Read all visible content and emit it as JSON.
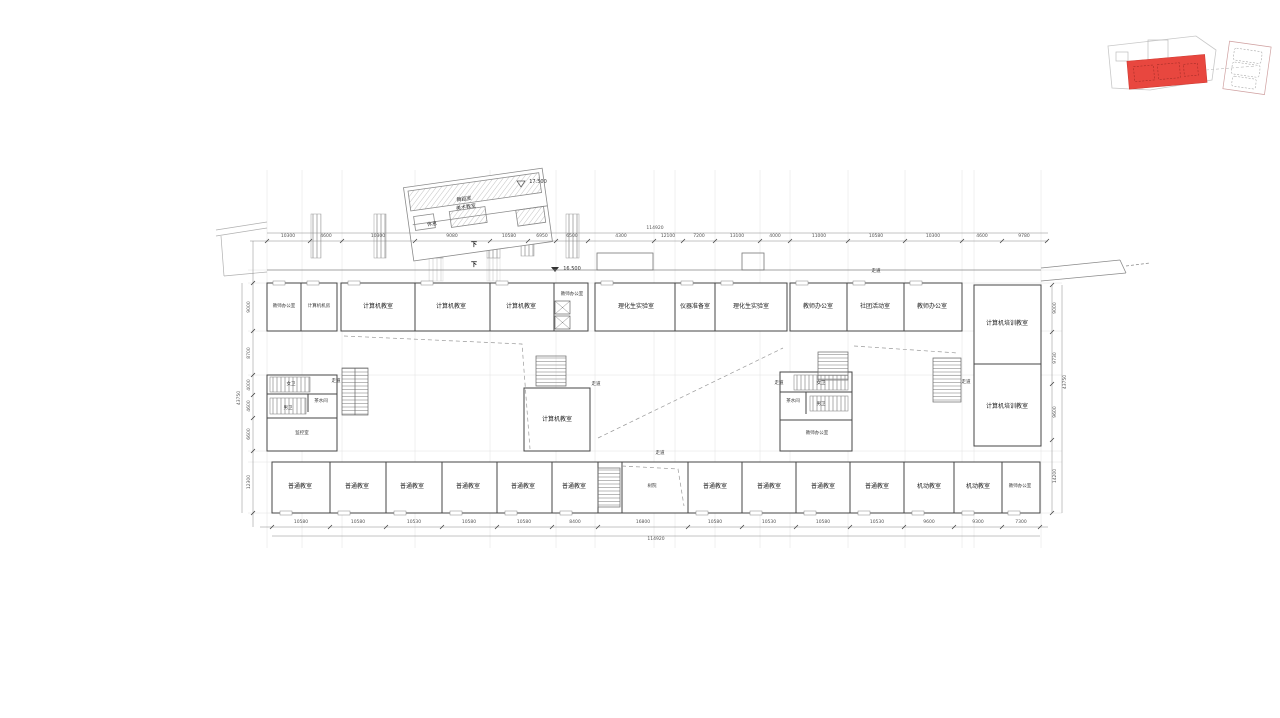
{
  "drawing": {
    "key_plan": {
      "highlight_color": "#e8473f"
    },
    "levels": {
      "annex": "17.500",
      "main": "16.500"
    },
    "labels": {
      "corridor": "走道",
      "down": "下",
      "annex_room1": "舞蹈室",
      "annex_room2": "美术教室",
      "annex_rest": "休息"
    },
    "rooms": {
      "top": [
        "教师办公室",
        "计算机机房",
        "计算机教室",
        "计算机教室",
        "计算机教室",
        "教师办公室",
        "理化生实验室",
        "仪器准备室",
        "理化生实验室",
        "教师办公室",
        "社团活动室",
        "教师办公室"
      ],
      "right_wing": [
        "计算机培训教室",
        "计算机培训教室"
      ],
      "core_left": {
        "women": "女卫",
        "men": "男卫",
        "tea": "茶水间",
        "monitor": "监控室"
      },
      "core_mid": {
        "women": "女卫",
        "men": "男卫",
        "tea": "茶水间",
        "office": "教师办公室"
      },
      "center_room": "计算机教室",
      "tree_court": "树院",
      "bottom": [
        "普通教室",
        "普通教室",
        "普通教室",
        "普通教室",
        "普通教室",
        "普通教室",
        "普通教室",
        "普通教室",
        "普通教室",
        "普通教室",
        "机动教室",
        "机动教室",
        "教师办公室"
      ]
    },
    "dims": {
      "top": [
        "10300",
        "4600",
        "10300",
        "9080",
        "10580",
        "6950",
        "6500",
        "4300",
        "12100",
        "7200",
        "13100",
        "4000",
        "11000",
        "10580",
        "10300",
        "4600",
        "9780"
      ],
      "top_total": "114920",
      "bottom": [
        "10580",
        "10580",
        "10530",
        "10580",
        "10580",
        "8400",
        "16800",
        "10580",
        "10530",
        "10580",
        "10530",
        "9600",
        "9300",
        "7300"
      ],
      "bottom_total": "114920",
      "left": [
        "9000",
        "8700",
        "4000",
        "4600",
        "6600",
        "12300"
      ],
      "left_total": "43750",
      "right": [
        "9000",
        "9730",
        "9600",
        "14200"
      ],
      "right_total": "43750"
    }
  }
}
